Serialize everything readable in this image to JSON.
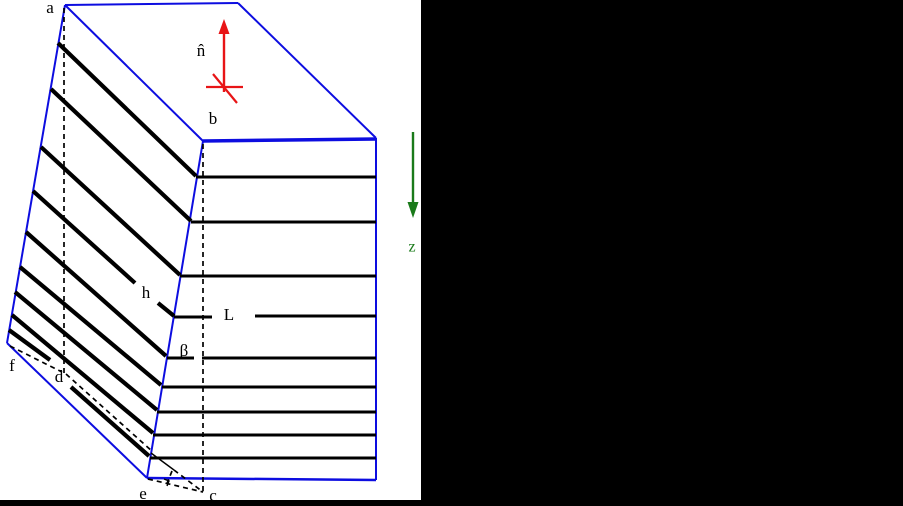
{
  "figure": {
    "width": 903,
    "height": 506,
    "background": "#ffffff",
    "colors": {
      "outline_blue": "#0d0de0",
      "layer_black": "#000000",
      "normal_arrow_red": "#e81416",
      "z_axis_green": "#1a7a1a",
      "panel_black": "#000000"
    },
    "panels": [
      {
        "name": "right-black-panel",
        "x": 421,
        "y": 0,
        "w": 482,
        "h": 506,
        "color": "#000000"
      },
      {
        "name": "bottom-black-panel",
        "x": 0,
        "y": 500,
        "w": 903,
        "h": 6,
        "color": "#000000"
      }
    ],
    "blue_edges": [
      {
        "name": "edge-top-back",
        "from": [
          65,
          5
        ],
        "to": [
          238,
          3
        ],
        "width": 2
      },
      {
        "name": "edge-top-right",
        "from": [
          238,
          3
        ],
        "to": [
          376,
          138
        ],
        "width": 2
      },
      {
        "name": "edge-top-front",
        "from": [
          203,
          141
        ],
        "to": [
          376,
          139
        ],
        "width": 3.5
      },
      {
        "name": "edge-top-left",
        "from": [
          65,
          5
        ],
        "to": [
          203,
          141
        ],
        "width": 2
      },
      {
        "name": "edge-left",
        "from": [
          65,
          5
        ],
        "to": [
          7,
          343
        ],
        "width": 2
      },
      {
        "name": "edge-bottom-left",
        "from": [
          7,
          343
        ],
        "to": [
          147,
          478
        ],
        "width": 2
      },
      {
        "name": "edge-front-left",
        "from": [
          203,
          141
        ],
        "to": [
          147,
          478
        ],
        "width": 2
      },
      {
        "name": "edge-front-right",
        "from": [
          376,
          138
        ],
        "to": [
          376,
          480
        ],
        "width": 2
      },
      {
        "name": "edge-front-bottom",
        "from": [
          147,
          478
        ],
        "to": [
          376,
          480
        ],
        "width": 2.5
      }
    ],
    "left_face_layers": [
      {
        "name": "layer-line",
        "segments": [
          [
            [
              58,
              43
            ],
            [
              196,
              176
            ]
          ]
        ]
      },
      {
        "name": "layer-line",
        "segments": [
          [
            [
              51,
              89
            ],
            [
              191,
              221
            ]
          ]
        ]
      },
      {
        "name": "layer-line",
        "segments": [
          [
            [
              41,
              147
            ],
            [
              180,
              275
            ]
          ]
        ]
      },
      {
        "name": "layer-line-h-gap",
        "segments": [
          [
            [
              33,
              191
            ],
            [
              135,
              283
            ]
          ],
          [
            [
              158,
              303
            ],
            [
              174,
              316
            ]
          ]
        ]
      },
      {
        "name": "layer-line",
        "segments": [
          [
            [
              26,
              232
            ],
            [
              166,
              356
            ]
          ]
        ]
      },
      {
        "name": "layer-line",
        "segments": [
          [
            [
              20,
              267
            ],
            [
              161,
              385
            ]
          ]
        ]
      },
      {
        "name": "layer-line",
        "segments": [
          [
            [
              15,
              292
            ],
            [
              157,
              410
            ]
          ]
        ]
      },
      {
        "name": "layer-line",
        "segments": [
          [
            [
              12,
              315
            ],
            [
              153,
              433
            ]
          ]
        ]
      },
      {
        "name": "layer-line-d-gap",
        "segments": [
          [
            [
              9,
              330
            ],
            [
              50,
              360
            ]
          ],
          [
            [
              71,
              387
            ],
            [
              149,
              456
            ]
          ]
        ]
      }
    ],
    "front_face_layers": [
      {
        "name": "front-layer-line",
        "segments": [
          [
            [
              196,
              177
            ],
            [
              376,
              177
            ]
          ]
        ]
      },
      {
        "name": "front-layer-line",
        "segments": [
          [
            [
              191,
              222
            ],
            [
              376,
              222
            ]
          ]
        ]
      },
      {
        "name": "front-layer-line",
        "segments": [
          [
            [
              180,
              276
            ],
            [
              376,
              276
            ]
          ]
        ]
      },
      {
        "name": "front-layer-line-L-gap",
        "segments": [
          [
            [
              174,
              317
            ],
            [
              212,
              317
            ]
          ],
          [
            [
              255,
              316
            ],
            [
              376,
              316
            ]
          ]
        ]
      },
      {
        "name": "front-layer-line-beta-gap",
        "segments": [
          [
            [
              167,
              358
            ],
            [
              194,
              358
            ]
          ],
          [
            [
              202,
              358
            ],
            [
              376,
              358
            ]
          ]
        ]
      },
      {
        "name": "front-layer-line",
        "segments": [
          [
            [
              162,
              387
            ],
            [
              376,
              387
            ]
          ]
        ]
      },
      {
        "name": "front-layer-line",
        "segments": [
          [
            [
              157,
              412
            ],
            [
              376,
              412
            ]
          ]
        ]
      },
      {
        "name": "front-layer-line",
        "segments": [
          [
            [
              153,
              435
            ],
            [
              376,
              435
            ]
          ]
        ]
      },
      {
        "name": "front-layer-line",
        "segments": [
          [
            [
              150,
              458
            ],
            [
              376,
              458
            ]
          ]
        ]
      }
    ],
    "dashed_guides": [
      {
        "name": "dashed-a-to-d",
        "from": [
          64,
          8
        ],
        "to": [
          64,
          375
        ]
      },
      {
        "name": "dashed-b-to-c",
        "from": [
          203,
          144
        ],
        "to": [
          203,
          492
        ]
      },
      {
        "name": "dashed-f-to-d",
        "from": [
          10,
          346
        ],
        "to": [
          62,
          372
        ]
      },
      {
        "name": "dashed-d-to-base",
        "from": [
          66,
          374
        ],
        "to": [
          153,
          452
        ]
      },
      {
        "name": "dashed-foot-to-c",
        "from": [
          174,
          470
        ],
        "to": [
          203,
          492
        ]
      },
      {
        "name": "dashed-e-to-c",
        "from": [
          148,
          479
        ],
        "to": [
          203,
          492
        ]
      },
      {
        "name": "dashed-perpendicular-tick",
        "from": [
          172,
          471
        ],
        "to": [
          166,
          486
        ]
      }
    ],
    "thin_solid_lines": [
      {
        "name": "thin-line-to-foot",
        "from": [
          151,
          453
        ],
        "to": [
          174,
          470
        ],
        "width": 1.4
      }
    ],
    "right_angle_marker": {
      "name": "right-angle-marker",
      "points": [
        [
          164,
          479
        ],
        [
          169,
          481
        ],
        [
          167,
          486
        ]
      ],
      "width": 1.4
    },
    "red_cross_lines": [
      {
        "name": "surface-line-horizontal",
        "from": [
          206,
          87
        ],
        "to": [
          243,
          87
        ],
        "width": 2.2
      },
      {
        "name": "surface-line-oblique",
        "from": [
          213,
          74
        ],
        "to": [
          237,
          103
        ],
        "width": 2.2
      }
    ],
    "arrows": [
      {
        "name": "normal-vector-arrow",
        "from": [
          224,
          92
        ],
        "to": [
          224,
          19
        ],
        "colorKey": "normal_arrow_red",
        "width": 2.4,
        "head": 15,
        "headw": 5.5
      },
      {
        "name": "z-axis-arrow",
        "from": [
          413,
          132
        ],
        "to": [
          413,
          218
        ],
        "colorKey": "z_axis_green",
        "width": 2.4,
        "head": 16,
        "headw": 5.5
      }
    ],
    "labels": [
      {
        "name": "vertex-label-a",
        "text": "a",
        "x": 50,
        "y": 9,
        "color": "#000000",
        "size": 17
      },
      {
        "name": "vertex-label-b",
        "text": "b",
        "x": 213,
        "y": 120,
        "color": "#000000",
        "size": 17
      },
      {
        "name": "vertex-label-c",
        "text": "c",
        "x": 213,
        "y": 497,
        "color": "#000000",
        "size": 17
      },
      {
        "name": "vertex-label-d",
        "text": "d",
        "x": 59,
        "y": 378,
        "color": "#000000",
        "size": 17
      },
      {
        "name": "vertex-label-e",
        "text": "e",
        "x": 143,
        "y": 495,
        "color": "#000000",
        "size": 17
      },
      {
        "name": "vertex-label-f",
        "text": "f",
        "x": 12,
        "y": 367,
        "color": "#000000",
        "size": 17
      },
      {
        "name": "dimension-label-h",
        "text": "h",
        "x": 146,
        "y": 294,
        "color": "#000000",
        "size": 17
      },
      {
        "name": "dimension-label-L",
        "text": "L",
        "x": 229,
        "y": 316,
        "color": "#000000",
        "size": 17
      },
      {
        "name": "angle-label-beta",
        "text": "β",
        "x": 184,
        "y": 352,
        "color": "#000000",
        "size": 17
      },
      {
        "name": "normal-vector-label-n-hat",
        "text": "n̂",
        "x": 201,
        "y": 52,
        "color": "#000000",
        "size": 17
      },
      {
        "name": "z-axis-label",
        "text": "z",
        "x": 412,
        "y": 248,
        "color": "#1a7a1a",
        "size": 16
      }
    ]
  }
}
